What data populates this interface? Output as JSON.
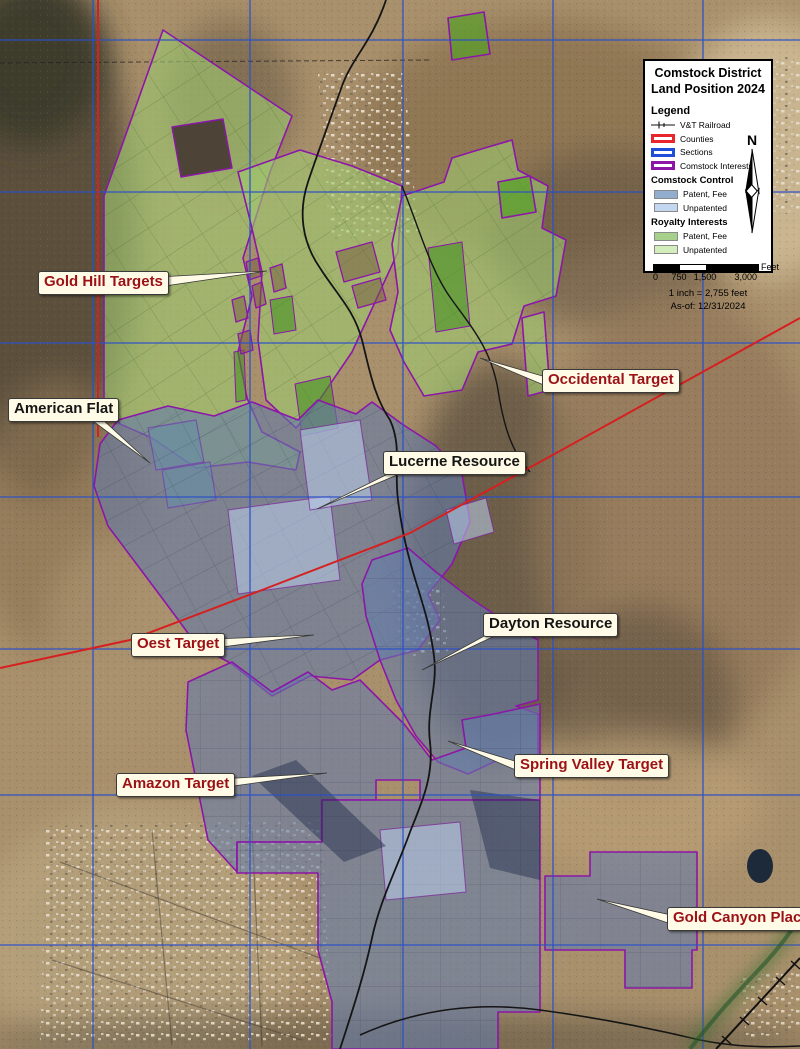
{
  "legend": {
    "title_line1": "Comstock District",
    "title_line2": "Land Position 2024",
    "heading": "Legend",
    "items": [
      {
        "label": "V&T Railroad",
        "type": "railroad-line"
      },
      {
        "label": "Counties",
        "type": "outline",
        "color": "#e8262b"
      },
      {
        "label": "Sections",
        "type": "outline",
        "color": "#1f4fd8"
      },
      {
        "label": "Comstock Interests",
        "type": "outline",
        "color": "#8c16a8"
      },
      {
        "label": "Comstock Control",
        "type": "subheading"
      },
      {
        "label": "Patent, Fee",
        "type": "fill",
        "color": "#92aecf"
      },
      {
        "label": "Unpatented",
        "type": "fill",
        "color": "#c3d8f0"
      },
      {
        "label": "Royalty Interests",
        "type": "subheading"
      },
      {
        "label": "Patent, Fee",
        "type": "fill",
        "color": "#a8d08d"
      },
      {
        "label": "Unpatented",
        "type": "fill",
        "color": "#d4edbc"
      }
    ],
    "scale_bar": {
      "ticks": [
        "0",
        "750",
        "1,500",
        "3,000"
      ],
      "unit": "Feet"
    },
    "scale_text": "1 inch = 2,755 feet",
    "as_of": "As-of: 12/31/2024",
    "north_label": "N"
  },
  "annotations": [
    {
      "text": "Gold Hill Targets",
      "kind": "target"
    },
    {
      "text": "Occidental Target",
      "kind": "target"
    },
    {
      "text": "American Flat",
      "kind": "resource"
    },
    {
      "text": "Lucerne Resource",
      "kind": "resource"
    },
    {
      "text": "Oest Target",
      "kind": "target"
    },
    {
      "text": "Dayton Resource",
      "kind": "resource"
    },
    {
      "text": "Amazon Target",
      "kind": "target"
    },
    {
      "text": "Spring Valley Target",
      "kind": "target"
    },
    {
      "text": "Gold Canyon Place",
      "kind": "target"
    }
  ],
  "colors": {
    "county_line": "#d62020",
    "section_line": "#2b50c8",
    "comstock_interest_outline": "#8c16a8",
    "control_patent_fill": "#92aecf",
    "control_unpatented_fill": "#c3d8f0",
    "royalty_patent_fill": "#a8d08d",
    "royalty_unpatented_fill": "#d4edbc",
    "target_label_text": "#9b1116",
    "resource_label_text": "#151515",
    "label_background": "#fffbe6"
  }
}
